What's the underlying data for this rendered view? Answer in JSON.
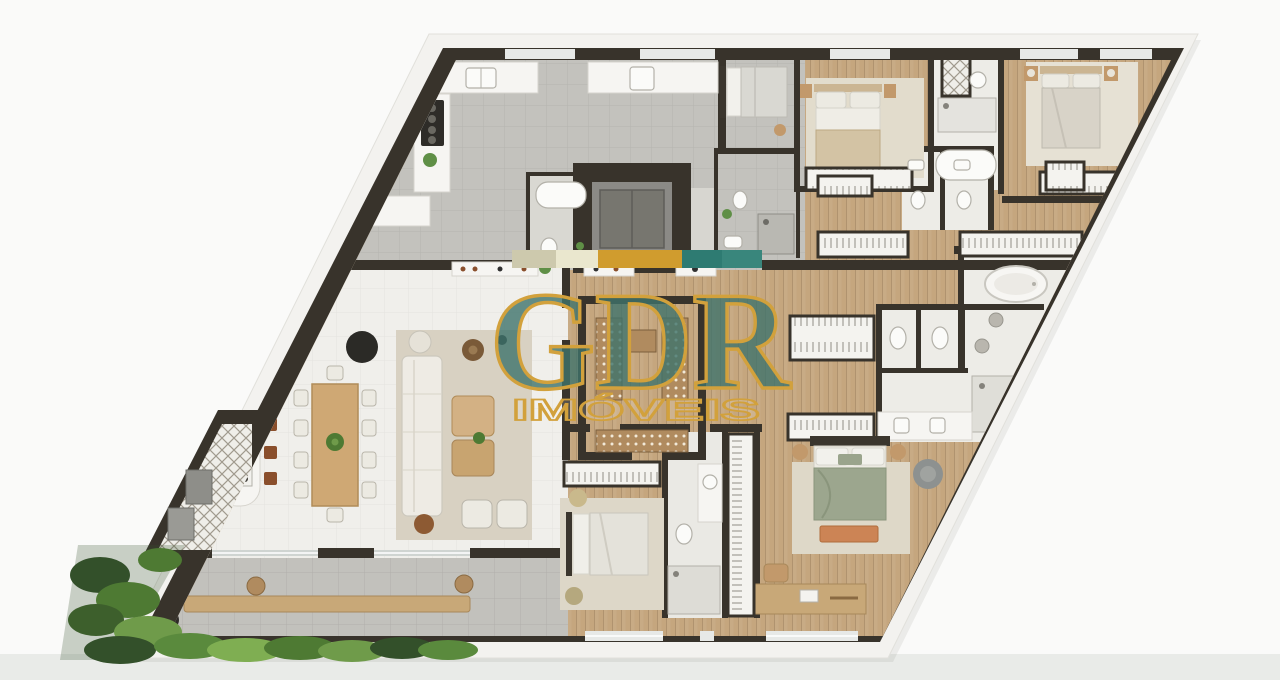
{
  "watermark": {
    "title": "GDR",
    "subtitle": "IMÓVEIS",
    "title_color": "#3e736c",
    "outline_color": "#d2a13c"
  },
  "brand_bar": {
    "segments": [
      {
        "name": "beige",
        "color": "#cdc9ad"
      },
      {
        "name": "cream",
        "color": "#eae7ce"
      },
      {
        "name": "gold",
        "color": "#d09c2e"
      },
      {
        "name": "teal-dark",
        "color": "#2e7b72"
      },
      {
        "name": "teal-light",
        "color": "#39867c"
      }
    ]
  },
  "palette": {
    "wall": "#38332b",
    "wood_floor": "#c5a67e",
    "gray_tile": "#c3c2bd",
    "white_tile": "#f0efeb",
    "terrace_paver": "#c2c1bc",
    "marble": "#edece7",
    "hedge_dark": "#33502a",
    "hedge_light": "#7fae52",
    "rug": "#d8d1c2",
    "sofa": "#eeebe4",
    "bed_sage": "#9ca68e",
    "bench_terracotta": "#cc8455",
    "stool_brown": "#8a4f2c",
    "counter_white": "#f6f5f2",
    "elevator_gray": "#77766f",
    "background": "#fafaf9",
    "background_band": "#e9ebe8"
  }
}
